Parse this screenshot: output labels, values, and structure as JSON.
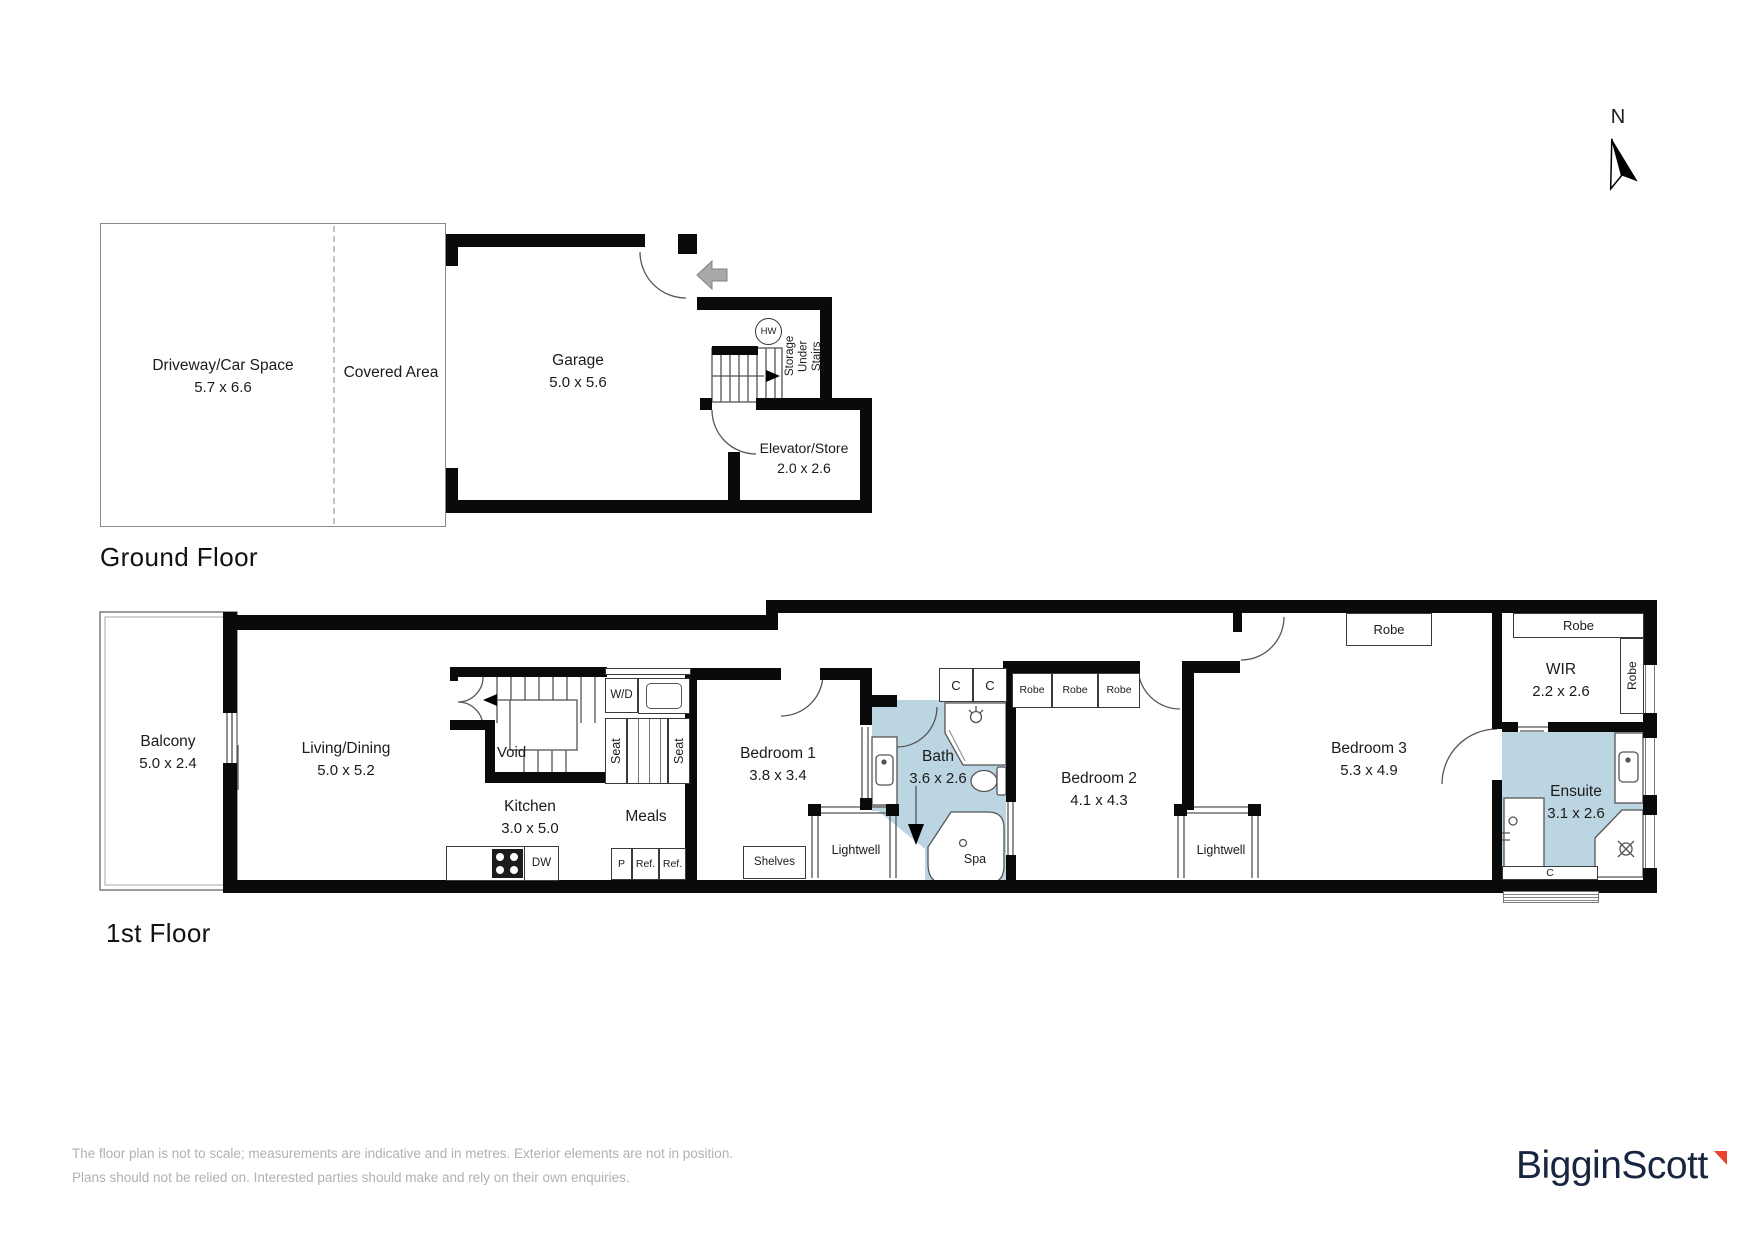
{
  "compass": {
    "label": "N"
  },
  "colors": {
    "wet_area": "#bcd5e2",
    "wall": "#0a0a0a",
    "entry_arrow": "#a9a9a9",
    "logo_navy": "#18253f",
    "logo_red": "#e8432e",
    "muted_text": "#b1b1b1"
  },
  "ground_floor": {
    "title": "Ground Floor",
    "driveway": {
      "name": "Driveway/Car Space",
      "dims": "5.7 x 6.6"
    },
    "covered_area": {
      "name": "Covered Area"
    },
    "garage": {
      "name": "Garage",
      "dims": "5.0 x 5.6"
    },
    "hot_water": "HW",
    "storage_lines": [
      "Storage",
      "Under",
      "Stairs"
    ],
    "elevator": {
      "name": "Elevator/Store",
      "dims": "2.0 x 2.6"
    }
  },
  "first_floor": {
    "title": "1st Floor",
    "balcony": {
      "name": "Balcony",
      "dims": "5.0 x 2.4"
    },
    "living": {
      "name": "Living/Dining",
      "dims": "5.0 x 5.2"
    },
    "void_label": "Void",
    "kitchen": {
      "name": "Kitchen",
      "dims": "3.0 x 5.0"
    },
    "meals": "Meals",
    "laundry": "W/D",
    "seat": "Seat",
    "appliances": {
      "dw": "DW",
      "pantry": "P",
      "fridge": "Ref."
    },
    "bed1": {
      "name": "Bedroom 1",
      "dims": "3.8 x 3.4"
    },
    "shelves": "Shelves",
    "lightwell": "Lightwell",
    "bath": {
      "name": "Bath",
      "dims": "3.6 x 2.6"
    },
    "spa": "Spa",
    "cupboard": "C",
    "robe": "Robe",
    "bed2": {
      "name": "Bedroom 2",
      "dims": "4.1 x 4.3"
    },
    "bed3": {
      "name": "Bedroom 3",
      "dims": "5.3 x 4.9"
    },
    "wir": {
      "name": "WIR",
      "dims": "2.2 x 2.6"
    },
    "ensuite": {
      "name": "Ensuite",
      "dims": "3.1 x 2.6"
    }
  },
  "footer": {
    "line1": "The floor plan is not to scale; measurements are indicative and in metres. Exterior elements are not in position.",
    "line2": "Plans should not be relied on. Interested parties should make and rely on their own enquiries."
  },
  "brand": {
    "logo_text": "BigginScott"
  }
}
